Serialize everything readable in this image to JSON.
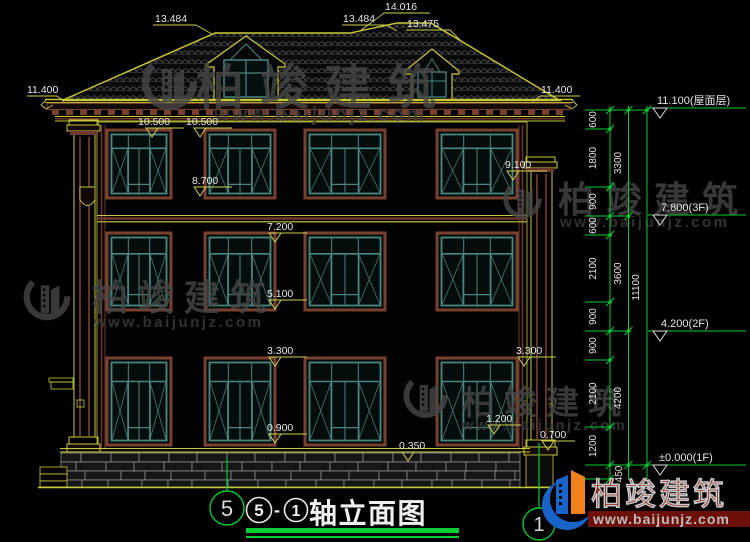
{
  "watermark": {
    "brand": "柏竣建筑",
    "site": "www.baijunjz.com"
  },
  "logo": {
    "brand": "柏竣建筑",
    "site": "www.baijunjz.com"
  },
  "title": {
    "axis_from": "5",
    "dash": "-",
    "axis_to": "1",
    "text": "轴立面图"
  },
  "axis_bubbles": {
    "left": "5",
    "right": "1"
  },
  "roof_labels": {
    "ridge_left": "13.484",
    "ridge_top": "14.016",
    "ridge_mid": "13.484",
    "ridge_right": "13.475"
  },
  "spot_levels": {
    "eave_left": "11.400",
    "eave_right": "11.400",
    "soffit_a": "10.500",
    "soffit_b": "10.500",
    "win3_sill": "8.700",
    "capital_right": "9.100",
    "belt": "7.200",
    "win2_sill": "5.100",
    "win1_head": "3.300",
    "win1_head_right": "3.300",
    "win1_sill": "0.900",
    "pier_right": "1.200",
    "pier_cap": "0.700",
    "base_top": "0.350"
  },
  "floor_levels": {
    "roof": "11.100(屋面层)",
    "f3": "7.800(3F)",
    "f2": "4.200(2F)",
    "f1": "±0.000(1F)"
  },
  "dim_chain": {
    "col1": [
      "600",
      "1800",
      "900",
      "600",
      "2100",
      "900",
      "900",
      "2100",
      "1200"
    ],
    "col1_below": "450",
    "col2": [
      "3300",
      "3600",
      "4200"
    ],
    "col3": [
      "11100"
    ]
  }
}
